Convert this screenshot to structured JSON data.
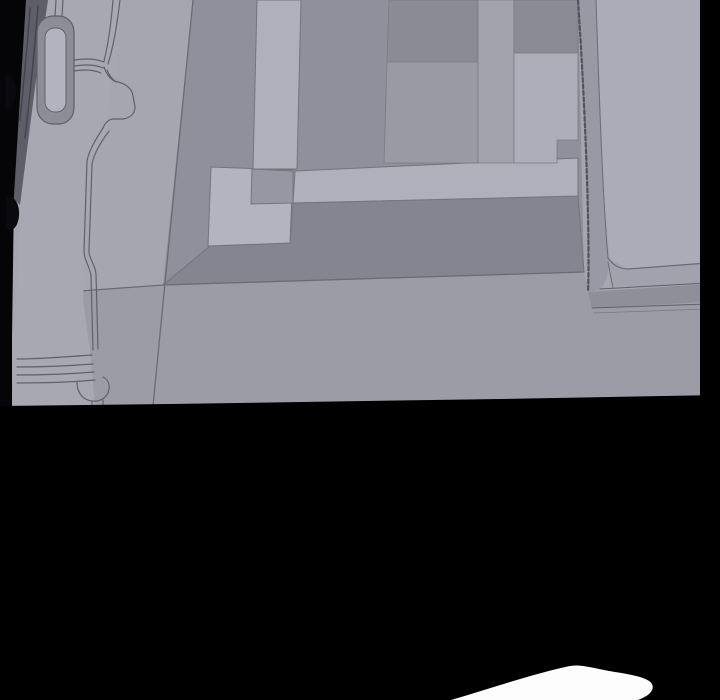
{
  "panel": {
    "kind": "comic-panel",
    "visible_text": "",
    "frame_color": "#000000",
    "accent_white": "#fdfdfe"
  },
  "colors": {
    "gutter_black": "#000000",
    "floor_base": "#a6a6b1",
    "floor_lower": "#9c9ca7",
    "rug_field": "#90909c",
    "rug_dark_band": "#858591",
    "rug_band_light": "#b0b0bc",
    "rug_square_light": "#b4b4c0",
    "rug_overlap": "#9797a3",
    "tile_dark": "#8b8b96",
    "tile_medium": "#9a9aa5",
    "tile_light": "#aeaeba",
    "platform_top": "#abacb8",
    "platform_face": "#a2a2ae",
    "rail": "#9899a4",
    "lip": "#8f8f9a",
    "door_face": "#a8a8b3",
    "door_edge": "#5e5e68",
    "line": "#6b6b75",
    "dark_line": "#53535d",
    "white_shape": "#fdfdfe"
  },
  "scene": {
    "width": 720,
    "height": 700,
    "shapes": [
      {
        "name": "gutter-background",
        "type": "polygon",
        "points": "0,0 720,0 720,700 0,700",
        "fill": "#000000"
      },
      {
        "name": "floor-base",
        "type": "polygon",
        "points": "12,0 707,0 701,396 170,405 12,407",
        "fill": "#a6a6b1"
      },
      {
        "name": "rug-field",
        "type": "polygon",
        "points": "193,0 578,0 584,272 163,285",
        "fill": "#90909c"
      },
      {
        "name": "rug-dark-band",
        "type": "polygon",
        "points": "163,285 210,246 290,243 293,203 578,196 584,272",
        "fill": "#858591",
        "stroke": "#74747e",
        "sw": 1
      },
      {
        "name": "rug-band-horizontal",
        "type": "polygon",
        "points": "295,171 578,158 578,196 293,203",
        "fill": "#b0b0bc",
        "stroke": "#74747e",
        "sw": 1
      },
      {
        "name": "rug-square-light",
        "type": "polygon",
        "points": "211,167 293,170 290,243 208,246",
        "fill": "#b4b4c0",
        "stroke": "#74747e",
        "sw": 1
      },
      {
        "name": "rug-overlap-square",
        "type": "polygon",
        "points": "252,169 293,171 293,203 251,204",
        "fill": "#9797a3",
        "stroke": "#74747e",
        "sw": 1
      },
      {
        "name": "rug-band-vertical",
        "type": "polygon",
        "points": "257,0 301,0 297,169 253,169",
        "fill": "#b0b0bc",
        "stroke": "#74747e",
        "sw": 1
      },
      {
        "name": "tile-dark-left",
        "type": "polygon",
        "points": "389,0 478,0 478,62 387,62",
        "fill": "#8b8b96",
        "stroke": "#7b7b85",
        "sw": 0.8
      },
      {
        "name": "tile-medium-left",
        "type": "polygon",
        "points": "387,62 478,62 478,163 384,163",
        "fill": "#9a9aa5",
        "stroke": "#7b7b85",
        "sw": 0.8
      },
      {
        "name": "tile-light-middle",
        "type": "polygon",
        "points": "478,0 514,0 514,163 478,163",
        "fill": "#a3a3ae",
        "stroke": "#7b7b85",
        "sw": 0.8
      },
      {
        "name": "tile-dark-right",
        "type": "polygon",
        "points": "514,0 578,0 578,53 514,53",
        "fill": "#8b8b96",
        "stroke": "#7b7b85",
        "sw": 0.8
      },
      {
        "name": "tile-light-right",
        "type": "polygon",
        "points": "514,53 578,53 578,140 557,140 557,163 514,163",
        "fill": "#aeaeba",
        "stroke": "#7b7b85",
        "sw": 0.8
      },
      {
        "name": "floor-lower",
        "type": "polygon",
        "points": "80,291 163,285 584,272 592,307 700,303 701,396 170,405 95,406 90,352 83,300",
        "fill": "#9c9ca7"
      },
      {
        "name": "floor-seam-diagonal",
        "type": "path",
        "d": "M193,0 L165,283 L153,406",
        "stroke": "#6b6b75",
        "sw": 1.3
      },
      {
        "name": "floor-seam-horizontal",
        "type": "path",
        "d": "M80,291 L163,285 L584,272",
        "stroke": "#6b6b75",
        "sw": 1.3
      },
      {
        "name": "bed-platform-top",
        "type": "polygon",
        "points": "596,0 707,0 707,288 613,286 604,200",
        "fill": "#abacb8"
      },
      {
        "name": "bed-platform-face",
        "type": "polygon",
        "points": "608,258 628,269 707,263 707,288 613,286",
        "fill": "#a2a2ae"
      },
      {
        "name": "bed-rail",
        "type": "path",
        "d": "M578,0 L596,0 C600,120 603,200 608,258 C610,272 606,282 600,290 L588,292 C590,240 586,120 578,0 Z",
        "fill": "#9899a4"
      },
      {
        "name": "bed-rail-edge-stitch",
        "type": "path",
        "d": "M578,0 C586,120 590,240 588,292",
        "stroke": "#53535d",
        "sw": 2.2,
        "dash": "4,2.5"
      },
      {
        "name": "bed-rail-inner-line",
        "type": "path",
        "d": "M596,0 C600,120 603,200 608,258",
        "stroke": "#6b6b75",
        "sw": 1
      },
      {
        "name": "bed-mattress-edge",
        "type": "path",
        "d": "M608,258 C614,266 620,269 628,269 L707,263",
        "stroke": "#6b6b75",
        "sw": 1.2
      },
      {
        "name": "bed-base-lip",
        "type": "polygon",
        "points": "588,292 707,284 707,302 592,308",
        "fill": "#8f8f9a"
      },
      {
        "name": "bed-lip-top-line",
        "type": "path",
        "d": "M600,289 L707,283",
        "stroke": "#60606a",
        "sw": 1
      },
      {
        "name": "bed-lip-bottom-line",
        "type": "path",
        "d": "M592,308 L707,304",
        "stroke": "#60606a",
        "sw": 1
      },
      {
        "name": "bed-lip-shadow-line",
        "type": "path",
        "d": "M594,313 L707,309",
        "stroke": "#7a7a84",
        "sw": 0.8
      },
      {
        "name": "bed-corner-tick",
        "type": "path",
        "d": "M608,262 L613,288",
        "stroke": "#6b6b75",
        "sw": 1
      },
      {
        "name": "panel-border-right",
        "type": "polygon",
        "points": "700,0 720,0 720,396 700,398",
        "fill": "#000000"
      },
      {
        "name": "door-face",
        "type": "polygon",
        "points": "28,0 122,0 104,140 86,165 83,300 90,352 95,405 12,407",
        "fill": "#a8a8b3"
      },
      {
        "name": "door-edge",
        "type": "polygon",
        "points": "20,0 48,0 36,80 27,150 20,205 13,198",
        "fill": "#5e5e68"
      },
      {
        "name": "door-edge-streaks",
        "type": "path",
        "d": "M30,8 C28,40 24,80 20,120 M38,6 C35,45 30,95 25,138",
        "stroke": "#42424b",
        "sw": 1.4
      },
      {
        "name": "panel-border-left",
        "type": "polygon",
        "points": "0,0 26,0 14,195 11,408 0,408",
        "fill": "#050507"
      },
      {
        "name": "door-handle-recess-outer",
        "type": "path",
        "d": "M54,16 L58,16 C68,16 74,23 74,33 L74,107 C74,117 68,124 58,124 L54,124 C44,124 37,117 37,107 L37,33 C37,23 44,16 54,16 Z",
        "fill": "#8d8d98",
        "stroke": "#5f5f69",
        "sw": 1.2
      },
      {
        "name": "door-handle-recess-inner",
        "type": "path",
        "d": "M55,28 L56,28 C62,28 66,32 66,38 L66,102 C66,108 62,112 56,112 L55,112 C50,112 45,108 45,102 L45,38 C45,31 50,28 55,28 Z",
        "fill": "#b3b3bf",
        "stroke": "#63636d",
        "sw": 1
      },
      {
        "name": "door-molding-top-connectors",
        "type": "path",
        "d": "M56,0 L55,16 M63,0 L62,16",
        "stroke": "#61616b",
        "sw": 1.2
      },
      {
        "name": "door-molding-horizontal-trio",
        "type": "path",
        "d": "M74,60 C88,58 96,59 104,62 M74,66 C88,64 96,65 103,68 M74,71 C86,69 94,70 101,73",
        "stroke": "#61616b",
        "sw": 1.2
      },
      {
        "name": "door-molding-vertical-pair",
        "type": "path",
        "d": "M113,0 C111,25 108,45 104,61 M120,0 C117,26 113,48 108,64",
        "stroke": "#61616b",
        "sw": 1.2
      },
      {
        "name": "door-molding-bracket",
        "type": "path",
        "d": "M104,67 C106,73 109,78 114,81 C125,83 132,88 133,96 L135,107 C135,114 130,118 123,119 L114,119 C108,119 105,123 103,128 M107,70 C109,75 112,79 116,82",
        "stroke": "#61616b",
        "sw": 1.2
      },
      {
        "name": "door-molding-descent",
        "type": "path",
        "d": "M103,128 C96,139 89,150 87,161 L84,250 C84,261 90,266 91,276 L93,350 M109,131 C101,142 94,153 92,164 L89,251 C89,259 95,264 96,274 L98,349",
        "stroke": "#61616b",
        "sw": 1.2
      },
      {
        "name": "door-molding-bottom-lines",
        "type": "path",
        "d": "M92,355 C65,357 38,359 17,359 M93,364 C68,366 40,367 17,367 M94,372 C70,374 42,375 17,375 M95,380 C74,382 46,383 17,383",
        "stroke": "#61616b",
        "sw": 1.2
      },
      {
        "name": "door-molding-foot",
        "type": "path",
        "d": "M77,382 C77,393 83,400 92,401 C101,402 108,397 109,389 C110,383 107,379 103,377 M92,401 L92,406 M103,400 L103,406",
        "stroke": "#61616b",
        "sw": 1.2
      },
      {
        "name": "door-hinge-nub-upper",
        "type": "path",
        "d": "M5,76 C12,72 17,82 16,94 C15,105 10,112 5,108 Z",
        "fill": "#0a0a0e"
      },
      {
        "name": "door-hinge-nub-lower",
        "type": "path",
        "d": "M6,198 C14,194 20,204 19,216 C18,227 12,233 6,229 Z",
        "fill": "#0a0a0e"
      },
      {
        "name": "gutter-bottom",
        "type": "polygon",
        "points": "0,406 170,404 500,399 720,395 720,700 0,700",
        "fill": "#000000"
      },
      {
        "name": "white-shape-bottom",
        "type": "path",
        "d": "M451,700 C492,688 536,673 570,666 C581,664 592,668 615,672 C634,675 649,678 652,684 C655,691 648,696 638,700 Z",
        "fill": "#fdfdfe"
      }
    ]
  }
}
